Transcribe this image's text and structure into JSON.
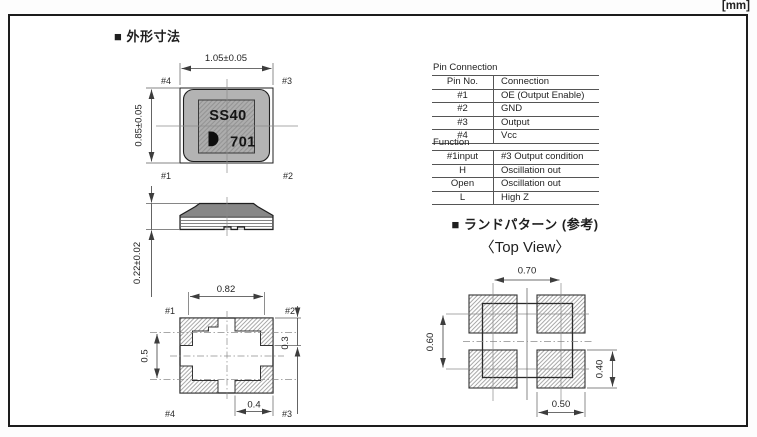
{
  "units_label": "[mm]",
  "outline_section": {
    "title": "■ 外形寸法",
    "top_view": {
      "dim_width": "1.05±0.05",
      "dim_height": "0.85±0.05",
      "marking_line1": "SS40",
      "marking_line2": "701",
      "pin_top_left": "#4",
      "pin_top_right": "#3",
      "pin_bottom_left": "#1",
      "pin_bottom_right": "#2"
    },
    "side_view": {
      "dim_height": "0.22±0.02"
    },
    "bottom_view": {
      "dim_width": "0.82",
      "dim_left": "0.5",
      "dim_right": "0.3",
      "dim_bottom": "0.4",
      "pin_top_left": "#1",
      "pin_top_right": "#2",
      "pin_bottom_left": "#4",
      "pin_bottom_right": "#3"
    }
  },
  "pin_connection_table": {
    "title": "Pin Connection",
    "col_headers": [
      "Pin No.",
      "Connection"
    ],
    "rows": [
      [
        "#1",
        "OE (Output Enable)"
      ],
      [
        "#2",
        "GND"
      ],
      [
        "#3",
        "Output"
      ],
      [
        "#4",
        "Vcc"
      ]
    ]
  },
  "function_table": {
    "title": "Function",
    "col_headers": [
      "#1input",
      "#3 Output condition"
    ],
    "rows": [
      [
        "H",
        "Oscillation out"
      ],
      [
        "Open",
        "Oscillation out"
      ],
      [
        "L",
        "High Z"
      ]
    ]
  },
  "land_pattern_section": {
    "title": "■ ランドパターン (参考)",
    "subtitle": "〈Top View〉",
    "dim_top": "0.70",
    "dim_left": "0.60",
    "dim_right": "0.40",
    "dim_bottom": "0.50"
  },
  "colors": {
    "frame_border": "#1c1c1c",
    "package_body_gray": "#b3b3b3",
    "marking_area_gray": "#adadad",
    "drawing_line": "#333333",
    "hatch_line": "#9a9a9a"
  }
}
